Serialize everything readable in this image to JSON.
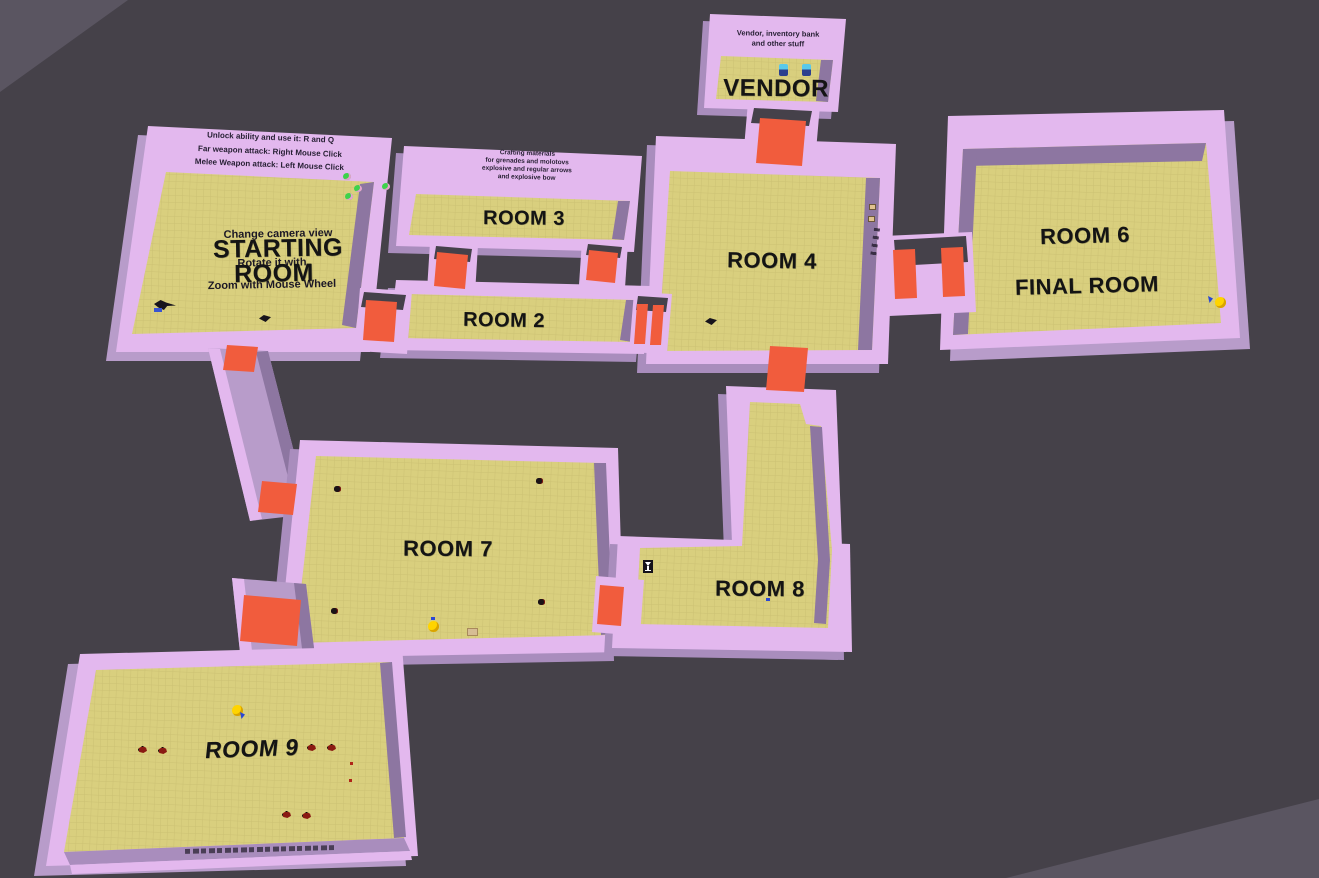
{
  "colors": {
    "background": "#5a5561",
    "ground": "#454149",
    "floor": "#d9cf7e",
    "wall_top": "#e3b8ee",
    "wall_side": "#a98dbd",
    "wall_tall": "#b89cca",
    "wall_dark": "#8d76a1",
    "wall_deep": "#45414a",
    "door": "#f15c3d",
    "label": "#141414",
    "text_dark": "#261f33",
    "slime": "#3ed24b",
    "orb": "#ffd400",
    "enemy": "#8a1a12",
    "npc_top": "#59c9ea",
    "npc_bottom": "#2b3f8e",
    "chest": "#e0c28f",
    "crate": "#d6bd94",
    "blue": "#2a48d4"
  },
  "rooms": {
    "starting": {
      "label_line1": "STARTING",
      "label_line2": "ROOM",
      "wall_text": [
        "Unlock ability and use it: R and Q",
        "Far weapon attack: Right Mouse Click",
        "Melee Weapon attack: Left Mouse Click"
      ],
      "floor_text": [
        "Change camera view",
        "Rotate it with",
        "Zoom with Mouse Wheel"
      ]
    },
    "room2": {
      "label": "ROOM 2"
    },
    "room3": {
      "label": "ROOM 3",
      "wall_text": [
        "Crafting materials",
        "for grenades and molotovs",
        "explosive and regular arrows",
        "and explosive bow"
      ]
    },
    "room4": {
      "label": "ROOM 4"
    },
    "vendor": {
      "label": "VENDOR",
      "wall_text": [
        "Vendor, inventory bank",
        "and other stuff"
      ]
    },
    "room6": {
      "label": "ROOM 6",
      "sublabel": "FINAL ROOM"
    },
    "room7": {
      "label": "ROOM 7"
    },
    "room8": {
      "label": "ROOM 8"
    },
    "room9": {
      "label": "ROOM 9"
    }
  },
  "icons": {
    "slime": "small green slime enemy",
    "orb": "gold orb pickup",
    "enemy": "small red enemy",
    "npc": "vendor npc",
    "chest": "small chest",
    "crate": "crate",
    "chalice": "chalice pickup",
    "crow": "crow / dark pickup",
    "door": "orange doorway"
  }
}
